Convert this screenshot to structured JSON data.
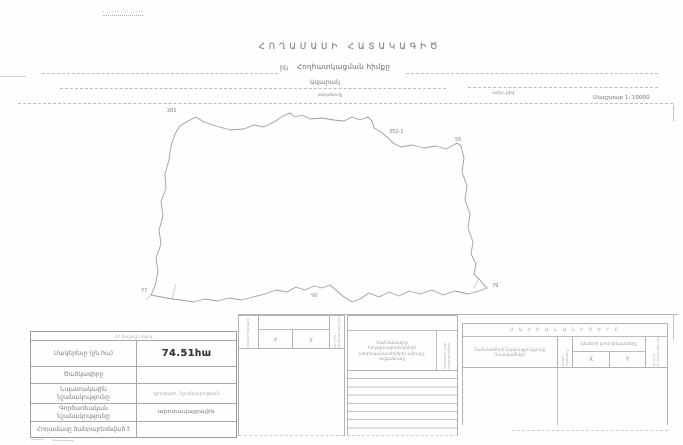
{
  "document": {
    "title": "ՀՈՂԱՄԱՍԻ ՀԱՏԱԿԱԳԻԾ",
    "allocation_prefix": "ին",
    "allocation_label": "Հողհատկացման հիմքը",
    "settlement": "Ագարակ",
    "settlement_caption": "անվանումը",
    "date_caption": "ամիս, թիվ",
    "scale": "Մասշտաբ 1։ 10000"
  },
  "map": {
    "point_labels": [
      "201",
      "352-1",
      "55",
      "79",
      "98",
      "77"
    ]
  },
  "left_table": {
    "region_header": "ՀՀ Տավուշի մարզ",
    "rows": [
      {
        "label": "Մակերեսը (ըն.հա)",
        "value": "74.51հա"
      },
      {
        "label": "Ծածկագիրը",
        "value": ""
      },
      {
        "label": "Նպատակային նշանակությունը",
        "value": "գյուղատ. նշանակության"
      },
      {
        "label": "Գործառնական նշանակությունը",
        "value": "արոտավայրային"
      },
      {
        "label": "Հողամասը ծանրաբեռնված է",
        "value": ""
      }
    ]
  },
  "coords_table": {
    "corner_label": "կետի համարը",
    "x_label": "x",
    "y_label": "y",
    "side_label": "կողմի երկարությունը"
  },
  "neighbors_table": {
    "header": "Սահմանակից հողօգտագործողների (սեփականատերերի) անունը, ազգանունը",
    "side_label": "համարն ըստ հատակագծի",
    "row_count": 8
  },
  "boundary_table": {
    "title": "Ս Ա Հ Մ Ա Ն Ա Ն Ի Շ Ե Ր Ը",
    "desc_header": "Սահմանների նկարագրությունը (հատվածներ)",
    "point_label": "կետի համարը",
    "coords_header": "կետերի կոորդինատները",
    "x_label": "X",
    "y_label": "Y",
    "side_label": "կողմի երկարությունը"
  }
}
